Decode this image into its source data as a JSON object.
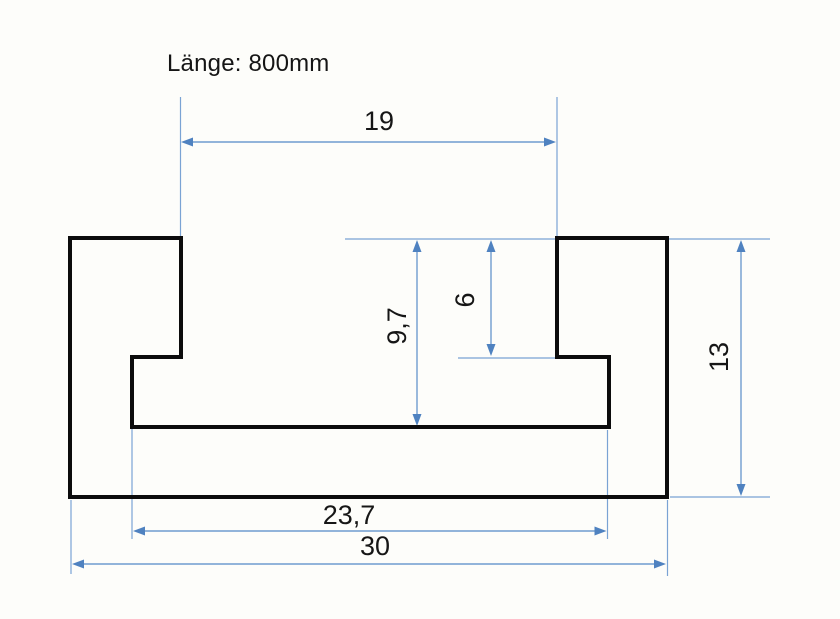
{
  "title": "Länge: 800mm",
  "drawing": {
    "type": "technical-cross-section-t-slot-profile",
    "dimensions": {
      "slot_opening_width": "19",
      "slot_depth": "9,7",
      "lip_depth": "6",
      "profile_height": "13",
      "cavity_width": "23,7",
      "profile_width": "30"
    },
    "colors": {
      "dimension_lines": "#6f9cd0",
      "dimension_arrows": "#4f82c0",
      "profile_outline": "#0c0c0c",
      "background": "#fdfdfa"
    }
  }
}
